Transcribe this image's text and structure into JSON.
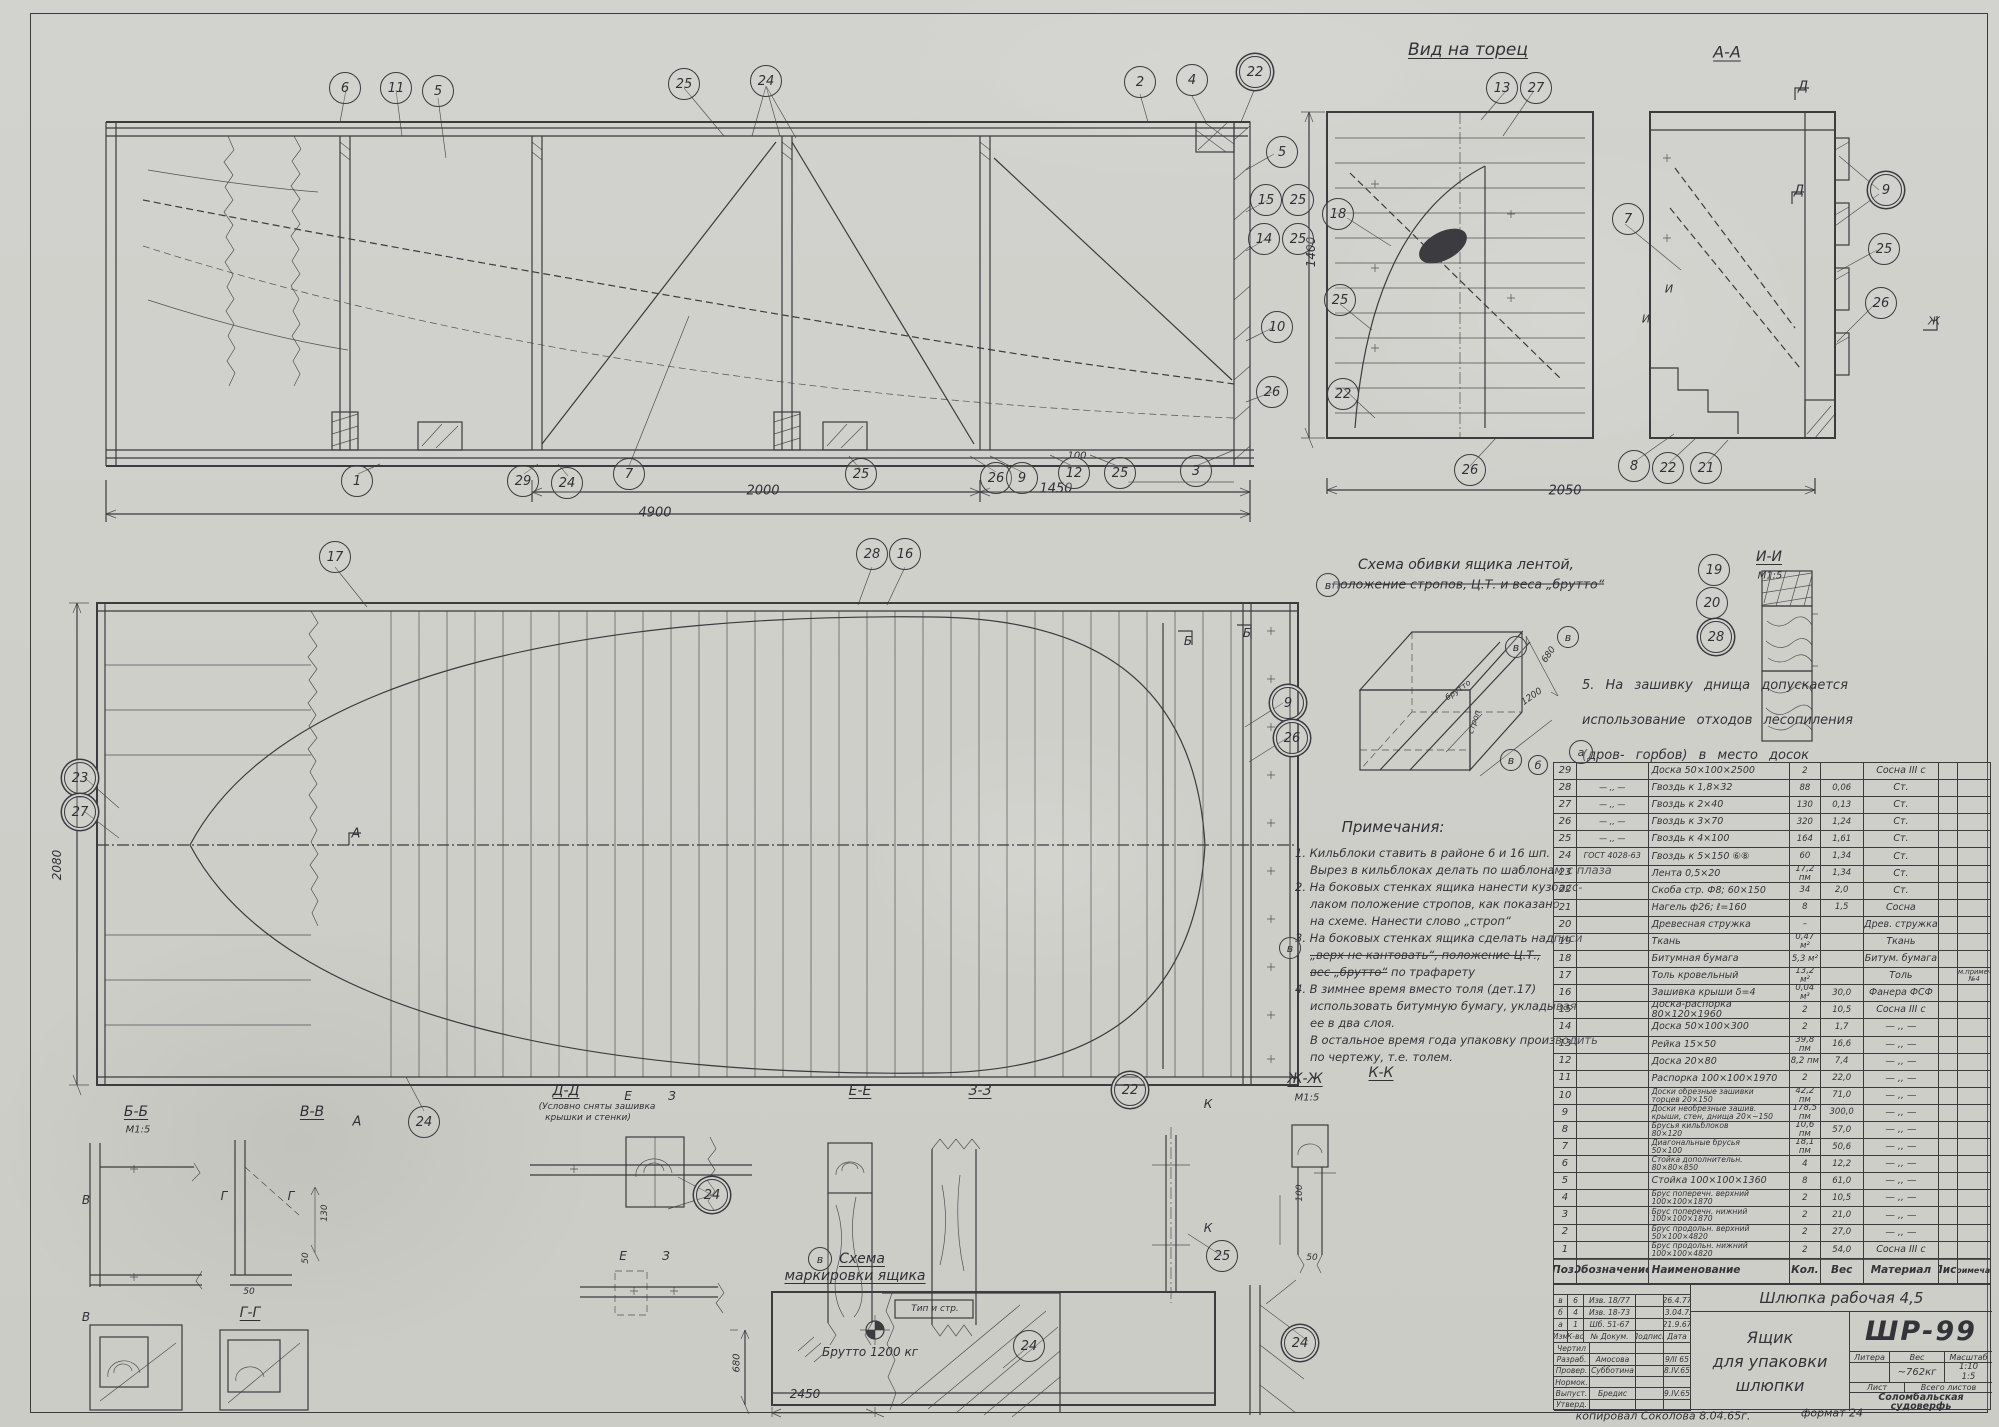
{
  "sheet": {
    "width": 1999,
    "height": 1427,
    "paper_color": "#d2d2ce",
    "ink_color": "#3b3b40"
  },
  "title_block": {
    "product": "Шлюпка рабочая 4,5",
    "name1": "Ящик",
    "name2": "для упаковки",
    "name3": "шлюпки",
    "number": "ШР-99",
    "litera_label": "Литера",
    "ves_label": "Вес",
    "masshtab_label": "Масштаб",
    "weight": "~762кг",
    "scale1": "1:10",
    "scale2": "1:5",
    "list_label": "Лист",
    "vsego_label": "Всего листов",
    "org1": "Соломбальская",
    "org2": "судоверфь",
    "rev_rows": [
      [
        "в",
        "6",
        "Изв. 18/77",
        "",
        "26.4.77"
      ],
      [
        "б",
        "4",
        "Изв. 18-73",
        "",
        "13.04.73"
      ],
      [
        "а",
        "1",
        "Шб. 51-67",
        "",
        "21.9.67"
      ],
      [
        "Изм",
        "К-во",
        "№ Докум.",
        "Подпись",
        "Дата"
      ]
    ],
    "sig_rows": [
      [
        "Чертил",
        "",
        "",
        ""
      ],
      [
        "Разраб.",
        "Амосова",
        "",
        "9/II 65"
      ],
      [
        "Провер.",
        "Субботина",
        "",
        "8.IV.65"
      ],
      [
        "Нормок.",
        "",
        "",
        ""
      ],
      [
        "Выпуст.",
        "Бредис",
        "",
        "9.IV.65"
      ],
      [
        "Утверд.",
        "",
        "",
        ""
      ]
    ]
  },
  "parts_table": {
    "col_widths": [
      23,
      72,
      142,
      31,
      43,
      76,
      19,
      32
    ],
    "headers": [
      "Поз.",
      "Обозначение",
      "Наименование",
      "Кол.",
      "Вес",
      "Материал",
      "Лист",
      "Примечан."
    ],
    "rows": [
      [
        "29",
        "",
        "Доска 50×100×2500",
        "2",
        "",
        "Сосна III с",
        "",
        " "
      ],
      [
        "28",
        "— ,, —",
        "Гвоздь к 1,8×32",
        "88",
        "0,06",
        "Ст.",
        "",
        " "
      ],
      [
        "27",
        "— ,, —",
        "Гвоздь к 2×40",
        "130",
        "0,13",
        "Ст.",
        "",
        " "
      ],
      [
        "26",
        "— ,, —",
        "Гвоздь к 3×70",
        "320",
        "1,24",
        "Ст.",
        "",
        " "
      ],
      [
        "25",
        "— ,, —",
        "Гвоздь к 4×100",
        "164",
        "1,61",
        "Ст.",
        "",
        " "
      ],
      [
        "24",
        "ГОСТ 4028-63",
        "Гвоздь к 5×150 ⑥⑧",
        "60",
        "1,34",
        "Ст.",
        "",
        " "
      ],
      [
        "23",
        "",
        "Лента 0,5×20",
        "17,2 пм",
        "1,34",
        "Ст.",
        "",
        " "
      ],
      [
        "22",
        "",
        "Скоба стр. Ф8; 60×150",
        "34",
        "2,0",
        "Ст.",
        "",
        " "
      ],
      [
        "21",
        "",
        "Нагель ф26; ℓ=160",
        "8",
        "1,5",
        "Сосна",
        "",
        " "
      ],
      [
        "20",
        "",
        "Древесная стружка",
        "–",
        "",
        "Древ. стружка",
        "",
        " "
      ],
      [
        "19",
        "",
        "Ткань",
        "0,47 м²",
        "",
        "Ткань",
        "",
        " "
      ],
      [
        "18",
        "",
        "Битумная бумага",
        "5,3 м²",
        "",
        "Битум. бумага",
        "",
        " "
      ],
      [
        "17",
        "",
        "Толь кровельный",
        "13,2 м²",
        "",
        "Толь",
        "",
        "см.примеч. №4"
      ],
      [
        "16",
        "",
        "Зашивка крыши δ=4",
        "0,04 м³",
        "30,0",
        "Фанера ФСФ",
        "",
        " "
      ],
      [
        "15",
        "",
        "Доска-распорка 80×120×1960",
        "2",
        "10,5",
        "Сосна III с",
        "",
        " "
      ],
      [
        "14",
        "",
        "Доска 50×100×300",
        "2",
        "1,7",
        "— ,, —",
        "",
        " "
      ],
      [
        "13",
        "",
        "Рейка 15×50",
        "39,8 пм",
        "16,6",
        "— ,, —",
        "",
        " "
      ],
      [
        "12",
        "",
        "Доска 20×80",
        "8,2 пм",
        "7,4",
        "— ,, —",
        "",
        " "
      ],
      [
        "11",
        "",
        "Распорка 100×100×1970",
        "2",
        "22,0",
        "— ,, —",
        "",
        " "
      ],
      [
        "10",
        "",
        "Доски обрезные зашивки\nторцев 20×150",
        "42,2 пм",
        "71,0",
        "— ,, —",
        "",
        " "
      ],
      [
        "9",
        "",
        "Доски необрезные зашив.\nкрыши, стен, днища 20×~150",
        "178,5 пм",
        "300,0",
        "— ,, —",
        "",
        " "
      ],
      [
        "8",
        "",
        "Брусья кильблоков\n80×120",
        "10,6 пм",
        "57,0",
        "— ,, —",
        "",
        " "
      ],
      [
        "7",
        "",
        "Диагональные брусья\n50×100",
        "18,1 пм",
        "50,6",
        "— ,, —",
        "",
        " "
      ],
      [
        "6",
        "",
        "Стойка дополнительн.\n80×80×850",
        "4",
        "12,2",
        "— ,, —",
        "",
        " "
      ],
      [
        "5",
        "",
        "Стойка 100×100×1360",
        "8",
        "61,0",
        "— ,, —",
        "",
        " "
      ],
      [
        "4",
        "",
        "Брус поперечн. верхний\n100×100×1870",
        "2",
        "10,5",
        "— ,, —",
        "",
        " "
      ],
      [
        "3",
        "",
        "Брус поперечн. нижний\n100×100×1870",
        "2",
        "21,0",
        "— ,, —",
        "",
        " "
      ],
      [
        "2",
        "",
        "Брус продольн. верхний\n50×100×4820",
        "2",
        "27,0",
        "— ,, —",
        "",
        " "
      ],
      [
        "1",
        "",
        "Брус продольн. нижний\n100×100×4820",
        "2",
        "54,0",
        "Сосна III с",
        "",
        " "
      ]
    ]
  },
  "notes": {
    "lines": [
      {
        "seg": [
          {
            "t": "1. Кильблоки ставить в районе 6 и 16 шп."
          }
        ]
      },
      {
        "seg": [
          {
            "t": "Вырез в кильблоках делать по шаблонам с плаза"
          }
        ],
        "ind": 1
      },
      {
        "seg": [
          {
            "t": "2. На боковых стенках ящика нанести кузбасс-"
          }
        ]
      },
      {
        "seg": [
          {
            "t": "лаком положение стропов, как показано"
          }
        ],
        "ind": 1
      },
      {
        "seg": [
          {
            "t": "на схеме. Нанести слово „строп“"
          }
        ],
        "ind": 1
      },
      {
        "seg": [
          {
            "t": "3. На боковых стенках ящика сделать надписи"
          }
        ]
      },
      {
        "seg": [
          {
            "t": "„верх не кантовать“, положение Ц.Т.,",
            "k": 1
          }
        ],
        "ind": 1
      },
      {
        "seg": [
          {
            "t": "вес „брутто“",
            "k": 1
          },
          {
            "t": " по трафарету"
          }
        ],
        "ind": 1
      },
      {
        "seg": [
          {
            "t": "4. В зимнее время вместо толя (дет.17)"
          }
        ]
      },
      {
        "seg": [
          {
            "t": "использовать битумную бумагу, укладывая"
          }
        ],
        "ind": 1
      },
      {
        "seg": [
          {
            "t": "ее в два слоя."
          }
        ],
        "ind": 1
      },
      {
        "seg": [
          {
            "t": "В остальное время года упаковку производить"
          }
        ],
        "ind": 1
      },
      {
        "seg": [
          {
            "t": "по чертежу, т.е. толем."
          }
        ],
        "ind": 1
      }
    ]
  },
  "note5_lines": [
    "5. На зашивку днища допускается",
    "использование отходов лесопиления",
    "(дров- горбов) в место досок"
  ],
  "labels": [
    {
      "t": "Вид на торец",
      "x": 1468,
      "y": 50,
      "s": 17,
      "u": 1,
      "n": "end-view-title"
    },
    {
      "t": "А-А",
      "x": 1727,
      "y": 52,
      "s": 16,
      "u": 1,
      "n": "section-aa-title"
    },
    {
      "t": "Д",
      "x": 1803,
      "y": 87,
      "s": 13
    },
    {
      "t": "Д",
      "x": 1799,
      "y": 191,
      "s": 13
    },
    {
      "t": "И",
      "x": 1669,
      "y": 289,
      "s": 11
    },
    {
      "t": "И",
      "x": 1646,
      "y": 319,
      "s": 11
    },
    {
      "t": "Ж",
      "x": 1934,
      "y": 321,
      "s": 11
    },
    {
      "t": "1400",
      "x": 1311,
      "y": 252,
      "s": 12,
      "r": -90
    },
    {
      "t": "2050",
      "x": 1565,
      "y": 491,
      "s": 13
    },
    {
      "t": "100",
      "x": 1077,
      "y": 456,
      "s": 10
    },
    {
      "t": "2000",
      "x": 763,
      "y": 491,
      "s": 13
    },
    {
      "t": "1450",
      "x": 1056,
      "y": 489,
      "s": 13
    },
    {
      "t": "4900",
      "x": 655,
      "y": 513,
      "s": 13
    },
    {
      "t": "2080",
      "x": 57,
      "y": 865,
      "s": 12,
      "r": -90
    },
    {
      "t": "А",
      "x": 356,
      "y": 834,
      "s": 13
    },
    {
      "t": "Б",
      "x": 1188,
      "y": 641,
      "s": 12
    },
    {
      "t": "Б",
      "x": 1247,
      "y": 633,
      "s": 12
    },
    {
      "t": "Схема обивки ящика лентой,",
      "x": 1466,
      "y": 565,
      "s": 14,
      "n": "banding-scheme-title"
    },
    {
      "t": "положение стропов, Ц.Т. и веса „брутто“",
      "x": 1468,
      "y": 584,
      "s": 12.5,
      "k": 1
    },
    {
      "t": "680",
      "x": 1549,
      "y": 655,
      "s": 9,
      "r": -55
    },
    {
      "t": "1200",
      "x": 1532,
      "y": 697,
      "s": 9,
      "r": -35
    },
    {
      "t": "строп",
      "x": 1474,
      "y": 722,
      "s": 8,
      "r": -72
    },
    {
      "t": "брутто",
      "x": 1458,
      "y": 690,
      "s": 8,
      "r": -35
    },
    {
      "t": "И-И",
      "x": 1769,
      "y": 557,
      "s": 14,
      "u": 1,
      "n": "detail-ii-title"
    },
    {
      "t": "М1:5",
      "x": 1770,
      "y": 576,
      "s": 10
    },
    {
      "t": "Примечания:",
      "x": 1393,
      "y": 827,
      "s": 15,
      "n": "notes-heading"
    },
    {
      "t": "Б-Б",
      "x": 136,
      "y": 1112,
      "s": 14,
      "u": 1
    },
    {
      "t": "М1:5",
      "x": 138,
      "y": 1130,
      "s": 10
    },
    {
      "t": "В-В",
      "x": 312,
      "y": 1112,
      "s": 14,
      "u": 1
    },
    {
      "t": "А",
      "x": 357,
      "y": 1122,
      "s": 13
    },
    {
      "t": "В",
      "x": 86,
      "y": 1200,
      "s": 12
    },
    {
      "t": "В",
      "x": 86,
      "y": 1317,
      "s": 12
    },
    {
      "t": "Г",
      "x": 224,
      "y": 1196,
      "s": 12
    },
    {
      "t": "Г",
      "x": 291,
      "y": 1196,
      "s": 12
    },
    {
      "t": "Г-Г",
      "x": 250,
      "y": 1313,
      "s": 14,
      "u": 1
    },
    {
      "t": "Д-Д",
      "x": 566,
      "y": 1091,
      "s": 14,
      "u": 1
    },
    {
      "t": "(Условно сняты зашивка",
      "x": 597,
      "y": 1107,
      "s": 9
    },
    {
      "t": "крышки и стенки)",
      "x": 588,
      "y": 1118,
      "s": 9
    },
    {
      "t": "Е",
      "x": 628,
      "y": 1096,
      "s": 12
    },
    {
      "t": "З",
      "x": 672,
      "y": 1096,
      "s": 12
    },
    {
      "t": "Е-Е",
      "x": 860,
      "y": 1091,
      "s": 14,
      "u": 1
    },
    {
      "t": "З-З",
      "x": 980,
      "y": 1091,
      "s": 14,
      "u": 1
    },
    {
      "t": "Е",
      "x": 623,
      "y": 1256,
      "s": 12
    },
    {
      "t": "З",
      "x": 666,
      "y": 1256,
      "s": 12
    },
    {
      "t": "Ж-Ж",
      "x": 1305,
      "y": 1079,
      "s": 14,
      "u": 1
    },
    {
      "t": "М1:5",
      "x": 1307,
      "y": 1098,
      "s": 10
    },
    {
      "t": "К-К",
      "x": 1381,
      "y": 1073,
      "s": 14,
      "u": 1
    },
    {
      "t": "К",
      "x": 1208,
      "y": 1104,
      "s": 12
    },
    {
      "t": "К",
      "x": 1208,
      "y": 1228,
      "s": 12
    },
    {
      "t": "130",
      "x": 325,
      "y": 1213,
      "s": 9,
      "r": -90
    },
    {
      "t": "50",
      "x": 306,
      "y": 1258,
      "s": 9,
      "r": -90
    },
    {
      "t": "50",
      "x": 249,
      "y": 1292,
      "s": 9
    },
    {
      "t": "100",
      "x": 1300,
      "y": 1193,
      "s": 9,
      "r": -90
    },
    {
      "t": "50",
      "x": 1312,
      "y": 1258,
      "s": 9
    },
    {
      "t": "Схема",
      "x": 862,
      "y": 1259,
      "s": 14,
      "u": 1,
      "n": "marking-scheme-title"
    },
    {
      "t": "маркировки ящика",
      "x": 855,
      "y": 1276,
      "s": 14,
      "u": 1
    },
    {
      "t": "Тип и стр.",
      "x": 935,
      "y": 1309,
      "s": 9
    },
    {
      "t": "Брутто 1200 кг",
      "x": 870,
      "y": 1352,
      "s": 12
    },
    {
      "t": "680",
      "x": 737,
      "y": 1363,
      "s": 10,
      "r": -90
    },
    {
      "t": "2450",
      "x": 805,
      "y": 1394,
      "s": 12
    },
    {
      "t": "копировал Соколова 8.04.65г.",
      "x": 1663,
      "y": 1416,
      "s": 11,
      "n": "copied-by"
    },
    {
      "t": "формат 24",
      "x": 1832,
      "y": 1413,
      "s": 11,
      "n": "format-label"
    }
  ],
  "callouts": [
    {
      "n": "6",
      "x": 345,
      "y": 88
    },
    {
      "n": "11",
      "x": 396,
      "y": 88
    },
    {
      "n": "5",
      "x": 438,
      "y": 91
    },
    {
      "n": "25",
      "x": 684,
      "y": 84
    },
    {
      "n": "24",
      "x": 766,
      "y": 81
    },
    {
      "n": "2",
      "x": 1140,
      "y": 82
    },
    {
      "n": "4",
      "x": 1192,
      "y": 80
    },
    {
      "n": "22",
      "x": 1255,
      "y": 72,
      "d": 1
    },
    {
      "n": "5",
      "x": 1282,
      "y": 152
    },
    {
      "n": "15",
      "x": 1266,
      "y": 200
    },
    {
      "n": "25",
      "x": 1298,
      "y": 200
    },
    {
      "n": "14",
      "x": 1264,
      "y": 239
    },
    {
      "n": "25",
      "x": 1298,
      "y": 239
    },
    {
      "n": "10",
      "x": 1277,
      "y": 327
    },
    {
      "n": "26",
      "x": 1272,
      "y": 392
    },
    {
      "n": "1",
      "x": 357,
      "y": 481
    },
    {
      "n": "29",
      "x": 523,
      "y": 481
    },
    {
      "n": "24",
      "x": 567,
      "y": 483
    },
    {
      "n": "7",
      "x": 629,
      "y": 474
    },
    {
      "n": "25",
      "x": 861,
      "y": 474
    },
    {
      "n": "26",
      "x": 996,
      "y": 478
    },
    {
      "n": "9",
      "x": 1022,
      "y": 478
    },
    {
      "n": "12",
      "x": 1074,
      "y": 473
    },
    {
      "n": "25",
      "x": 1120,
      "y": 473
    },
    {
      "n": "3",
      "x": 1196,
      "y": 471
    },
    {
      "n": "17",
      "x": 335,
      "y": 557
    },
    {
      "n": "28",
      "x": 872,
      "y": 554
    },
    {
      "n": "16",
      "x": 905,
      "y": 554
    },
    {
      "n": "23",
      "x": 80,
      "y": 778,
      "d": 1
    },
    {
      "n": "27",
      "x": 80,
      "y": 812,
      "d": 1
    },
    {
      "n": "9",
      "x": 1288,
      "y": 703,
      "d": 1
    },
    {
      "n": "26",
      "x": 1292,
      "y": 738,
      "d": 1
    },
    {
      "n": "24",
      "x": 424,
      "y": 1122
    },
    {
      "n": "13",
      "x": 1502,
      "y": 88
    },
    {
      "n": "27",
      "x": 1536,
      "y": 88
    },
    {
      "n": "18",
      "x": 1338,
      "y": 214
    },
    {
      "n": "7",
      "x": 1628,
      "y": 219
    },
    {
      "n": "9",
      "x": 1886,
      "y": 190,
      "d": 1
    },
    {
      "n": "25",
      "x": 1884,
      "y": 249
    },
    {
      "n": "26",
      "x": 1881,
      "y": 303
    },
    {
      "n": "25",
      "x": 1340,
      "y": 300
    },
    {
      "n": "22",
      "x": 1343,
      "y": 394
    },
    {
      "n": "26",
      "x": 1470,
      "y": 470
    },
    {
      "n": "8",
      "x": 1634,
      "y": 466
    },
    {
      "n": "22",
      "x": 1668,
      "y": 468
    },
    {
      "n": "21",
      "x": 1706,
      "y": 468
    },
    {
      "n": "19",
      "x": 1714,
      "y": 570
    },
    {
      "n": "20",
      "x": 1712,
      "y": 603
    },
    {
      "n": "28",
      "x": 1716,
      "y": 637,
      "d": 1
    },
    {
      "n": "24",
      "x": 712,
      "y": 1195,
      "d": 1
    },
    {
      "n": "22",
      "x": 1130,
      "y": 1090,
      "d": 1
    },
    {
      "n": "25",
      "x": 1222,
      "y": 1256
    },
    {
      "n": "24",
      "x": 1029,
      "y": 1346
    },
    {
      "n": "24",
      "x": 1300,
      "y": 1343,
      "d": 1
    },
    {
      "n": "в",
      "x": 1328,
      "y": 585,
      "r": 11
    },
    {
      "n": "в",
      "x": 1516,
      "y": 647,
      "r": 10
    },
    {
      "n": "в",
      "x": 1568,
      "y": 637,
      "r": 10
    },
    {
      "n": "в",
      "x": 1511,
      "y": 760,
      "r": 10
    },
    {
      "n": "а",
      "x": 1581,
      "y": 752,
      "r": 11
    },
    {
      "n": "в",
      "x": 820,
      "y": 1259,
      "r": 11
    },
    {
      "n": "в",
      "x": 1290,
      "y": 948,
      "r": 10
    },
    {
      "n": "б",
      "x": 1538,
      "y": 765,
      "r": 9
    }
  ]
}
